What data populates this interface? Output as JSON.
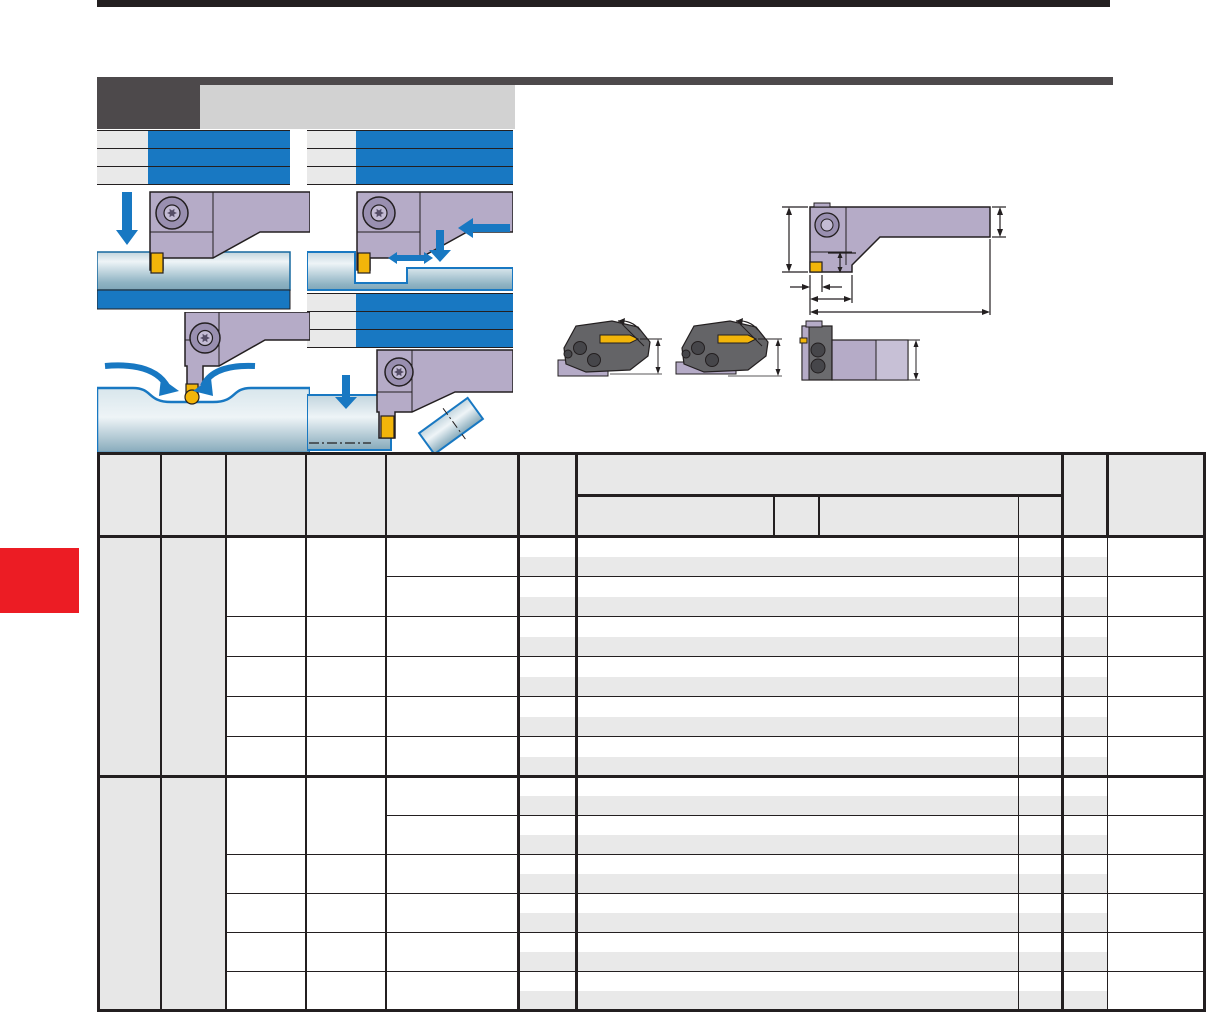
{
  "page": {
    "kind": "tooling-catalog-page",
    "all_text_redacted": true
  },
  "colors": {
    "redaction_bar_blue": "#1878c2",
    "arrow_blue": "#1878c2",
    "side_tab_red": "#ec1c24",
    "top_rule_black": "#231f20",
    "header_block_dark_gray": "#4d494b",
    "header_block_light_gray": "#d2d2d2",
    "table_border": "#231f20",
    "table_header_gray": "#e8e8e8",
    "table_stripe_gray": "#e9e9e9",
    "table_section_gray": "#e7e7e7",
    "tool_holder_purple": "#b5abc7",
    "screw_outer_purple": "#998fb0",
    "insert_yellow": "#f2b50a",
    "workpiece_blue_gray": "#9dbcca",
    "cutting_head_dark_gray": "#646467"
  },
  "redacted_blocks": {
    "top_left_heading_rows": 3,
    "top_right_heading_rows": 3,
    "mid_right_heading_rows": 3,
    "left_solid_band_rows": 1
  },
  "figures": [
    {
      "name": "grooving-application",
      "arrow_icons": [
        "feed-down-arrow"
      ]
    },
    {
      "name": "turning-application",
      "arrow_icons": [
        "feed-left-arrow",
        "feed-down-arrow",
        "feed-left-right-arrow"
      ]
    },
    {
      "name": "profiling-application",
      "arrow_icons": [
        "curved-feed-arrow-left",
        "curved-feed-arrow-right"
      ]
    },
    {
      "name": "parting-off-application",
      "arrow_icons": [
        "feed-down-arrow"
      ]
    },
    {
      "name": "holder-dimension-drawing",
      "dimension_labels": ""
    },
    {
      "name": "cutting-head-side-views",
      "view_count": 3
    }
  ],
  "table": {
    "header_levels": 2,
    "column_count": 12,
    "grouped_header_subcolumns": 4,
    "body_sections": 2,
    "row_pairs_per_section": 6,
    "cell_values": ""
  }
}
